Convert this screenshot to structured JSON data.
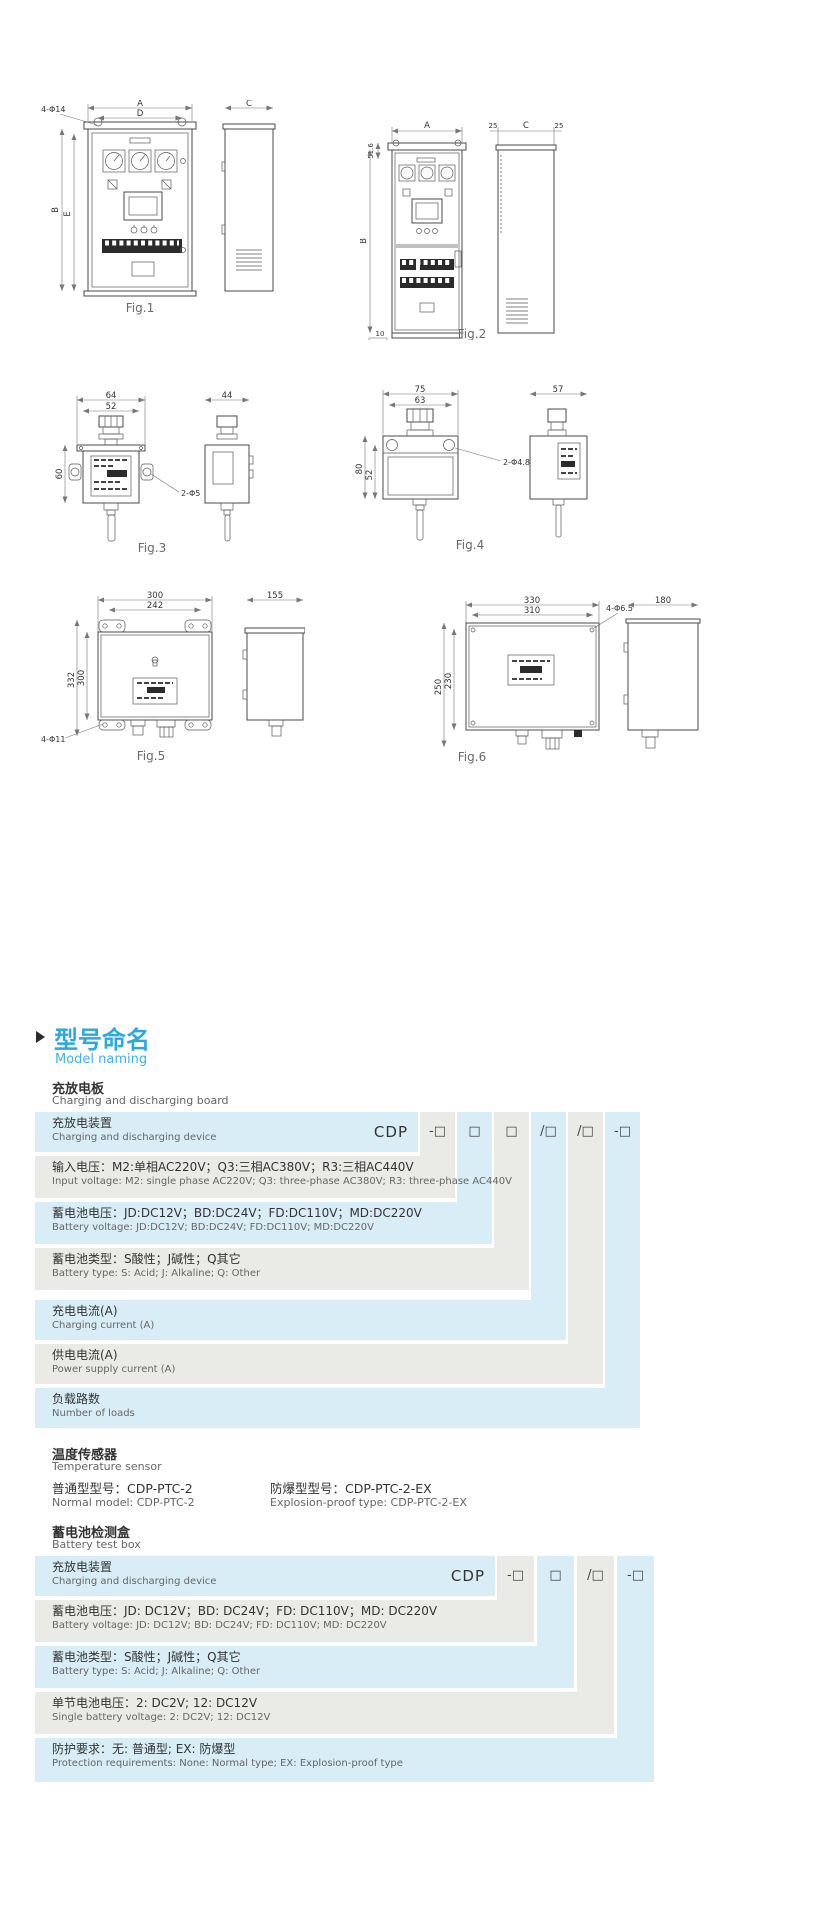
{
  "page": {
    "background": "#ffffff"
  },
  "colors": {
    "accent_blue": "#2ba9de",
    "row_blue": "#d9edf6",
    "row_gray": "#eaeae7"
  },
  "figures": {
    "fig1": {
      "label": "Fig.1",
      "dim_a": "A",
      "dim_d": "D",
      "dim_b": "B",
      "dim_e": "E",
      "dim_c": "C",
      "holes": "4-Φ14"
    },
    "fig2": {
      "label": "Fig.2",
      "dim_a": "A",
      "dim_top": "51.6",
      "dim_b": "B",
      "dim_25l": "25",
      "dim_c": "C",
      "dim_25r": "25",
      "dim_10": "10",
      "dim_100": "100"
    },
    "fig3": {
      "label": "Fig.3",
      "dim_w_outer": "64",
      "dim_w_inner": "52",
      "dim_h": "60",
      "holes": "2-Φ5",
      "dim_side": "44"
    },
    "fig4": {
      "label": "Fig.4",
      "dim_w_outer": "75",
      "dim_w_inner": "63",
      "dim_h_outer": "80",
      "dim_h_inner": "52",
      "holes": "2-Φ4.8",
      "dim_side": "57"
    },
    "fig5": {
      "label": "Fig.5",
      "dim_w_outer": "300",
      "dim_w_inner": "242",
      "dim_h_outer": "332",
      "dim_h_inner": "300",
      "holes": "4-Φ11",
      "dim_side": "155"
    },
    "fig6": {
      "label": "Fig.6",
      "dim_w_outer": "330",
      "dim_w_inner": "310",
      "dim_h_outer": "250",
      "dim_h_inner": "230",
      "holes": "4-Φ6.5",
      "dim_side": "180"
    }
  },
  "section": {
    "title_zh": "型号命名",
    "title_en": "Model naming"
  },
  "board": {
    "title_zh": "充放电板",
    "title_en": "Charging and discharging board"
  },
  "table1": {
    "prefix": "CDP",
    "cells": [
      "-□",
      "□",
      "□",
      "/□",
      "/□",
      "-□"
    ],
    "rows": [
      {
        "zh": "充放电装置",
        "en": "Charging and discharging device"
      },
      {
        "zh": "输入电压：M2:单相AC220V；Q3:三相AC380V；R3:三相AC440V",
        "en": "Input voltage: M2: single phase AC220V; Q3: three-phase AC380V; R3: three-phase AC440V"
      },
      {
        "zh": "蓄电池电压：JD:DC12V；BD:DC24V；FD:DC110V；MD:DC220V",
        "en": "Battery voltage: JD:DC12V; BD:DC24V; FD:DC110V; MD:DC220V"
      },
      {
        "zh": "蓄电池类型：S酸性；J碱性；Q其它",
        "en": "Battery type: S: Acid; J: Alkaline; Q: Other"
      },
      {
        "zh": "充电电流(A)",
        "en": "Charging current (A)"
      },
      {
        "zh": "供电电流(A)",
        "en": "Power supply current (A)"
      },
      {
        "zh": "负载路数",
        "en": "Number of loads"
      }
    ]
  },
  "sensor": {
    "title_zh": "温度传感器",
    "title_en": "Temperature sensor",
    "normal_zh": "普通型型号：CDP-PTC-2",
    "explosion_zh": "防爆型型号：CDP-PTC-2-EX",
    "normal_en": "Normal model: CDP-PTC-2",
    "explosion_en": "Explosion-proof type: CDP-PTC-2-EX"
  },
  "testbox": {
    "title_zh": "蓄电池检测盒",
    "title_en": "Battery test box"
  },
  "table2": {
    "prefix": "CDP",
    "cells": [
      "-□",
      "□",
      "/□",
      "-□"
    ],
    "rows": [
      {
        "zh": "充放电装置",
        "en": "Charging and discharging device"
      },
      {
        "zh": "蓄电池电压：JD: DC12V；BD: DC24V；FD: DC110V；MD: DC220V",
        "en": "Battery voltage: JD: DC12V; BD: DC24V; FD: DC110V; MD: DC220V"
      },
      {
        "zh": "蓄电池类型：S酸性；J碱性；Q其它",
        "en": "Battery type: S: Acid; J: Alkaline; Q: Other"
      },
      {
        "zh": "单节电池电压：2: DC2V; 12: DC12V",
        "en": "Single battery voltage:  2: DC2V; 12: DC12V"
      },
      {
        "zh": "防护要求：无: 普通型; EX: 防爆型",
        "en": "Protection requirements:  None: Normal type; EX: Explosion-proof type"
      }
    ]
  }
}
